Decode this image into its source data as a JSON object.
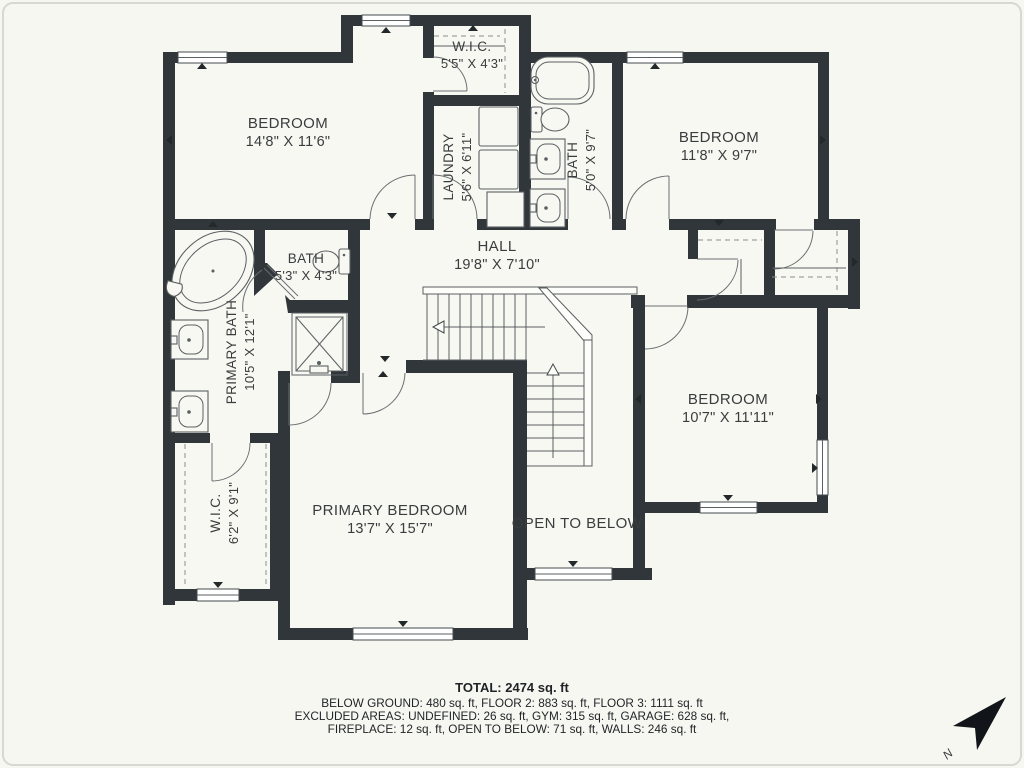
{
  "plan": {
    "rooms": [
      {
        "id": "bedroom-1",
        "name": "BEDROOM",
        "dims": "14'8\" X 11'6\""
      },
      {
        "id": "wic-upper",
        "name": "W.I.C.",
        "dims": "5'5\" X 4'3\""
      },
      {
        "id": "laundry",
        "name": "LAUNDRY",
        "dims": "5'6\" X 6'11\""
      },
      {
        "id": "bath-upper",
        "name": "BATH",
        "dims": "5'0\" X 9'7\""
      },
      {
        "id": "bedroom-2",
        "name": "BEDROOM",
        "dims": "11'8\" X 9'7\""
      },
      {
        "id": "hall",
        "name": "HALL",
        "dims": "19'8\" X 7'10\""
      },
      {
        "id": "bath-small",
        "name": "BATH",
        "dims": "5'3\" X 4'3\""
      },
      {
        "id": "primary-bath",
        "name": "PRIMARY BATH",
        "dims": "10'5\" X 12'1\""
      },
      {
        "id": "bedroom-3",
        "name": "BEDROOM",
        "dims": "10'7\" X 11'11\""
      },
      {
        "id": "wic-primary",
        "name": "W.I.C.",
        "dims": "6'2\" X 9'1\""
      },
      {
        "id": "primary-bedroom",
        "name": "PRIMARY BEDROOM",
        "dims": "13'7\" X 15'7\""
      },
      {
        "id": "open-below",
        "name": "OPEN TO BELOW",
        "dims": ""
      }
    ],
    "summary": {
      "total": "TOTAL: 2474 sq. ft",
      "floors": "BELOW GROUND: 480 sq. ft, FLOOR 2: 883 sq. ft, FLOOR 3: 1111 sq. ft",
      "excluded_1": "EXCLUDED AREAS: UNDEFINED: 26 sq. ft, GYM: 315 sq. ft, GARAGE: 628 sq. ft,",
      "excluded_2": "FIREPLACE: 12 sq. ft, OPEN TO BELOW: 71 sq. ft, WALLS: 246 sq. ft"
    },
    "compass_label": "N",
    "colors": {
      "wall": "#30363a",
      "floor": "#f8f8f2",
      "background": "#f7f7f1",
      "line": "#5a5f62"
    }
  }
}
